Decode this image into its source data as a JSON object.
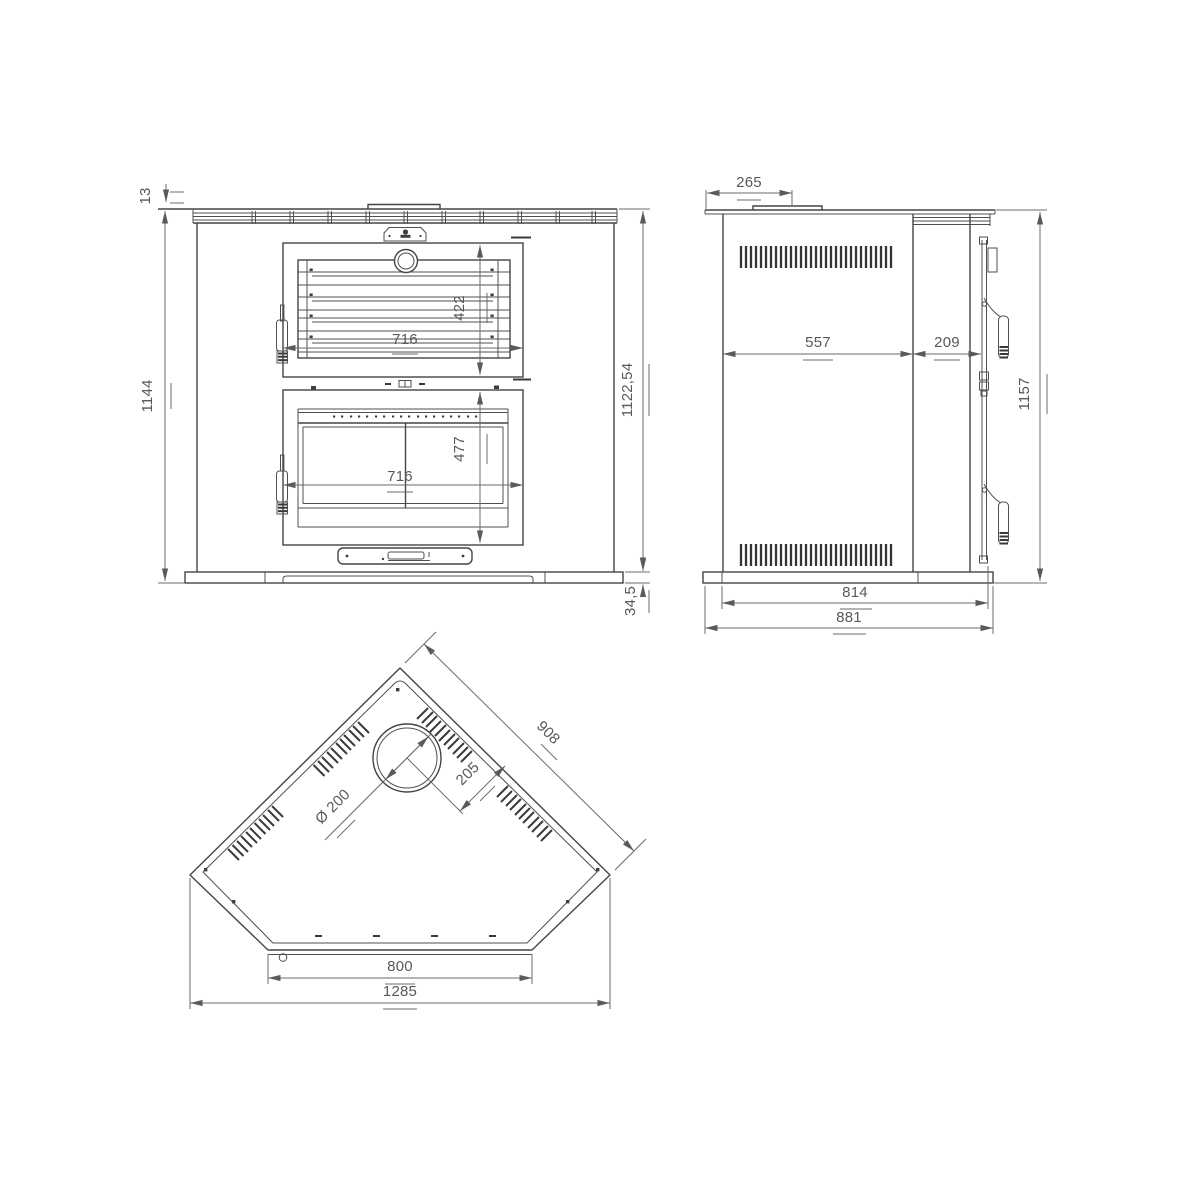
{
  "colors": {
    "background": "#ffffff",
    "line": "#454545",
    "dim": "#6b6b6b"
  },
  "views": {
    "front": {
      "dims": {
        "top_lip": "13",
        "overall_height": "1144",
        "upper_door_height": "422",
        "upper_door_width": "716",
        "body_height": "1122,54",
        "base_height": "34,5",
        "lower_door_height": "477",
        "lower_door_width": "716"
      }
    },
    "side": {
      "dims": {
        "top_offset": "265",
        "body_depth": "557",
        "door_depth": "209",
        "overall_height": "1157",
        "base_depth": "814",
        "base_depth_overall": "881"
      }
    },
    "top": {
      "dims": {
        "side_edge_length": "908",
        "flue_to_edge": "205",
        "flue_diameter": "Ø 200",
        "front_width": "800",
        "overall_width": "1285"
      }
    }
  }
}
